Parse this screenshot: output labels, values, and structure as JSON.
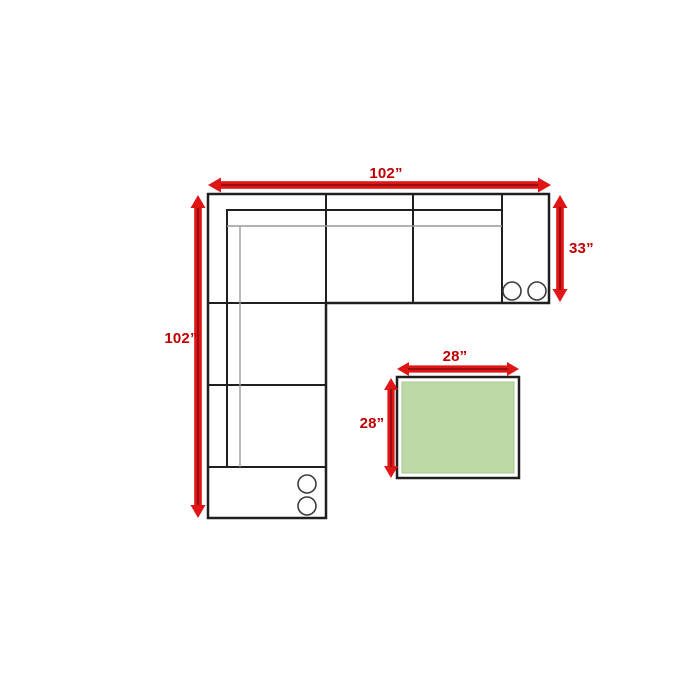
{
  "page": {
    "background": "#ffffff",
    "description": "Sectional sofa with ottoman dimension diagram"
  },
  "diagram": {
    "sofa": {
      "width_label": "102”",
      "height_label": "102”",
      "depth_label": "33”",
      "sections": 4,
      "cupholder_count": 4
    },
    "ottoman": {
      "width_label": "28”",
      "height_label": "28”",
      "fill": "#bed8a8",
      "edge": "#a6c98c"
    },
    "colors": {
      "arrow": "#e01515",
      "arrow_stripe": "#8f0d0d",
      "label": "#c00000",
      "outline": "#1f1f1f",
      "inner_line": "#999999",
      "circle_stroke": "#3c3c3c",
      "white": "#ffffff"
    }
  }
}
